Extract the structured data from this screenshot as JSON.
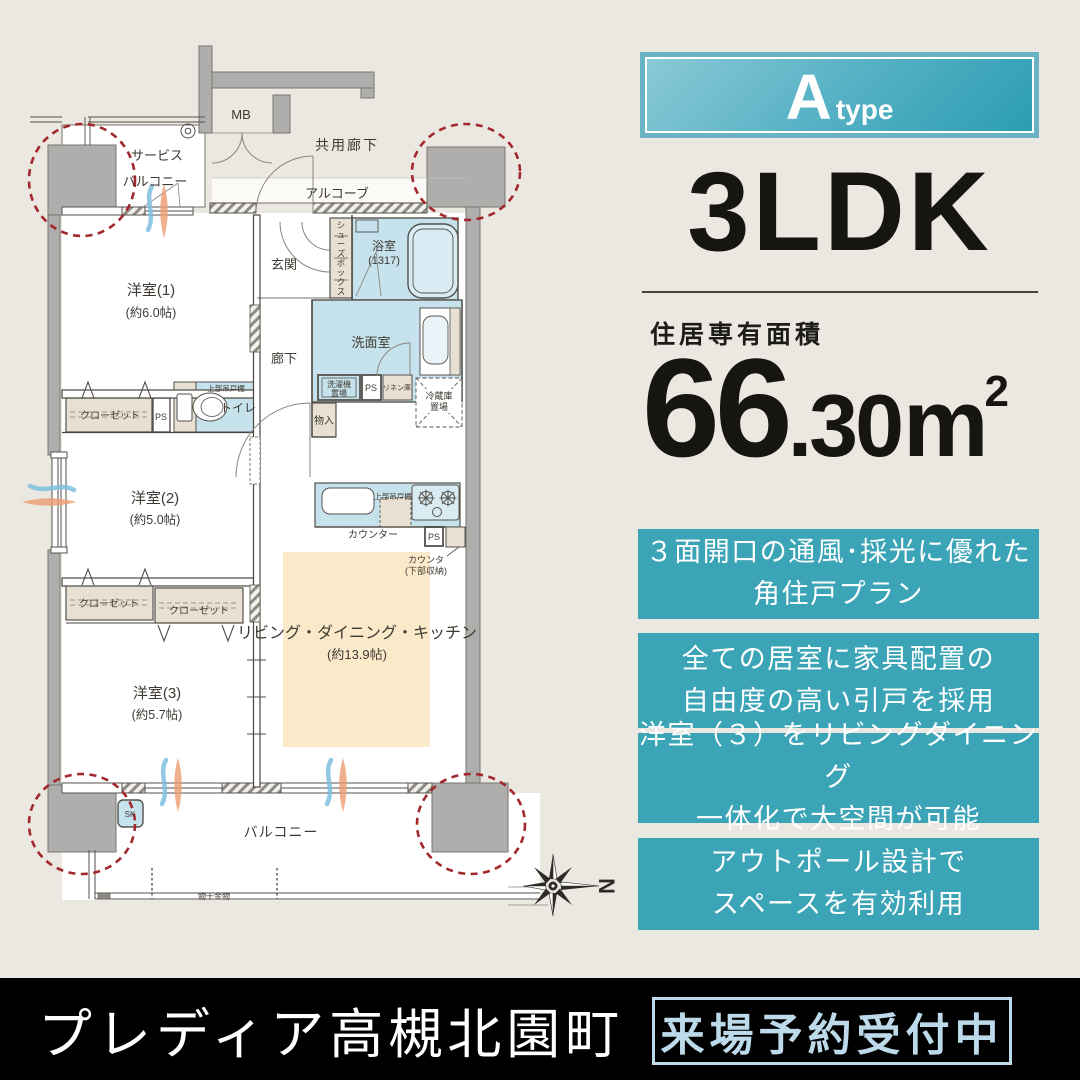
{
  "colors": {
    "background": "#EBE8E1",
    "accent_teal": "#3BA4B6",
    "badge_gradient_start": "#8BC9D6",
    "badge_gradient_end": "#2B9DB3",
    "water_room_blue": "#C6E2EC",
    "ldk_cream": "#FAEACA",
    "closet_beige": "#E8E1D3",
    "wall_gray": "#AFAEAC",
    "red_dashed_circle": "#A3282E",
    "footer_background": "#000000",
    "footer_badge_blue": "#BCDAE9"
  },
  "panel": {
    "badge_letter": "A",
    "badge_word": "type",
    "layout": "3LDK",
    "area_label": "住居専有面積",
    "area_whole": "66",
    "area_frac": ".30",
    "area_unit": "m",
    "area_exp": "2",
    "features": [
      {
        "line1": "３面開口の通風･採光に優れた",
        "line2": "角住戸プラン"
      },
      {
        "line1": "全ての居室に家具配置の",
        "line2": "自由度の高い引戸を採用"
      },
      {
        "line1": "洋室（３）をリビングダイニング",
        "line2": "一体化で大空間が可能"
      },
      {
        "line1": "アウトポール設計で",
        "line2": "スペースを有効利用"
      }
    ]
  },
  "footer": {
    "title": "プレディア高槻北園町",
    "badge": "来場予約受付中"
  },
  "floor_plan": {
    "labels": {
      "mb": "MB",
      "common_corridor": "共用廊下",
      "alcove": "アルコーブ",
      "service_balcony_1": "サービス",
      "service_balcony_2": "バルコニー",
      "genkan": "玄関",
      "shoes_box": "シューズボックス",
      "bath_name": "浴室",
      "bath_size": "(1317)",
      "washroom": "洗面室",
      "washer_1": "洗濯機",
      "washer_2": "置場",
      "ps1": "PS",
      "linen": "リネン庫",
      "fridge_1": "冷蔵庫",
      "fridge_2": "置場",
      "corridor": "廊下",
      "monoire": "物入",
      "toilet_shelf": "上部吊戸棚",
      "toilet": "トイレ",
      "closet_y2": "クローゼット",
      "ps2": "PS",
      "room1_name": "洋室(1)",
      "room1_size": "(約6.0帖)",
      "room2_name": "洋室(2)",
      "room2_size": "(約5.0帖)",
      "room3_name": "洋室(3)",
      "room3_size": "(約5.7帖)",
      "closet_y3a": "クローゼット",
      "closet_y3b": "クローゼット",
      "kitchen_shelf": "上部吊戸棚",
      "counter": "カウンター",
      "ps3": "PS",
      "counter_note_1": "カウンタ",
      "counter_note_2": "(下部収納)",
      "ldk_name": "リビング・ダイニング・キッチン",
      "ldk_size": "(約13.9帖)",
      "balcony": "バルコニー",
      "sk": "SK",
      "monohoshi": "物干金物",
      "compass_n": "N"
    }
  }
}
